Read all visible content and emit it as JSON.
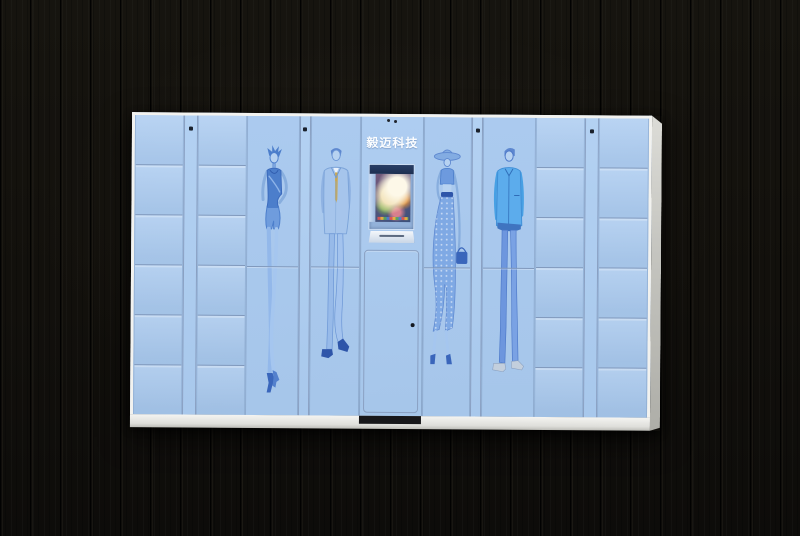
{
  "scene": {
    "type": "product-photo",
    "subject": "smart parcel locker cabinet with fashion illustration artwork",
    "backdrop": "dark vertical wood plank wall"
  },
  "palette": {
    "backdrop_wood": "#110f0c",
    "locker_front_blue": "#aac9ee",
    "door_seam": "#8199bc",
    "frame_white": "#f2f2ef",
    "side_panel_gray": "#c6c6c1",
    "artwork_blue": "#4c7ecb",
    "screen_frame_navy": "#22365c",
    "brand_text_color": "#fdfeff"
  },
  "cabinet": {
    "brand_label": "毅迈科技",
    "layout": {
      "left_small_columns": 2,
      "right_small_columns": 2,
      "doors_per_small_column": 6,
      "figure_panels": 4,
      "figure_panel_door_rows": 2,
      "lock_dots": 4
    },
    "figures": [
      "woman-in-tank-top-and-shorts",
      "man-in-suit-with-tie",
      "woman-with-wide-brim-hat-and-long-skirt",
      "man-in-casual-jacket-and-jeans"
    ],
    "console": {
      "screen_content": "bright promotional image on touchscreen",
      "has_pickup_shelf": true,
      "keyholes": 1,
      "vent_dots": 2
    }
  }
}
